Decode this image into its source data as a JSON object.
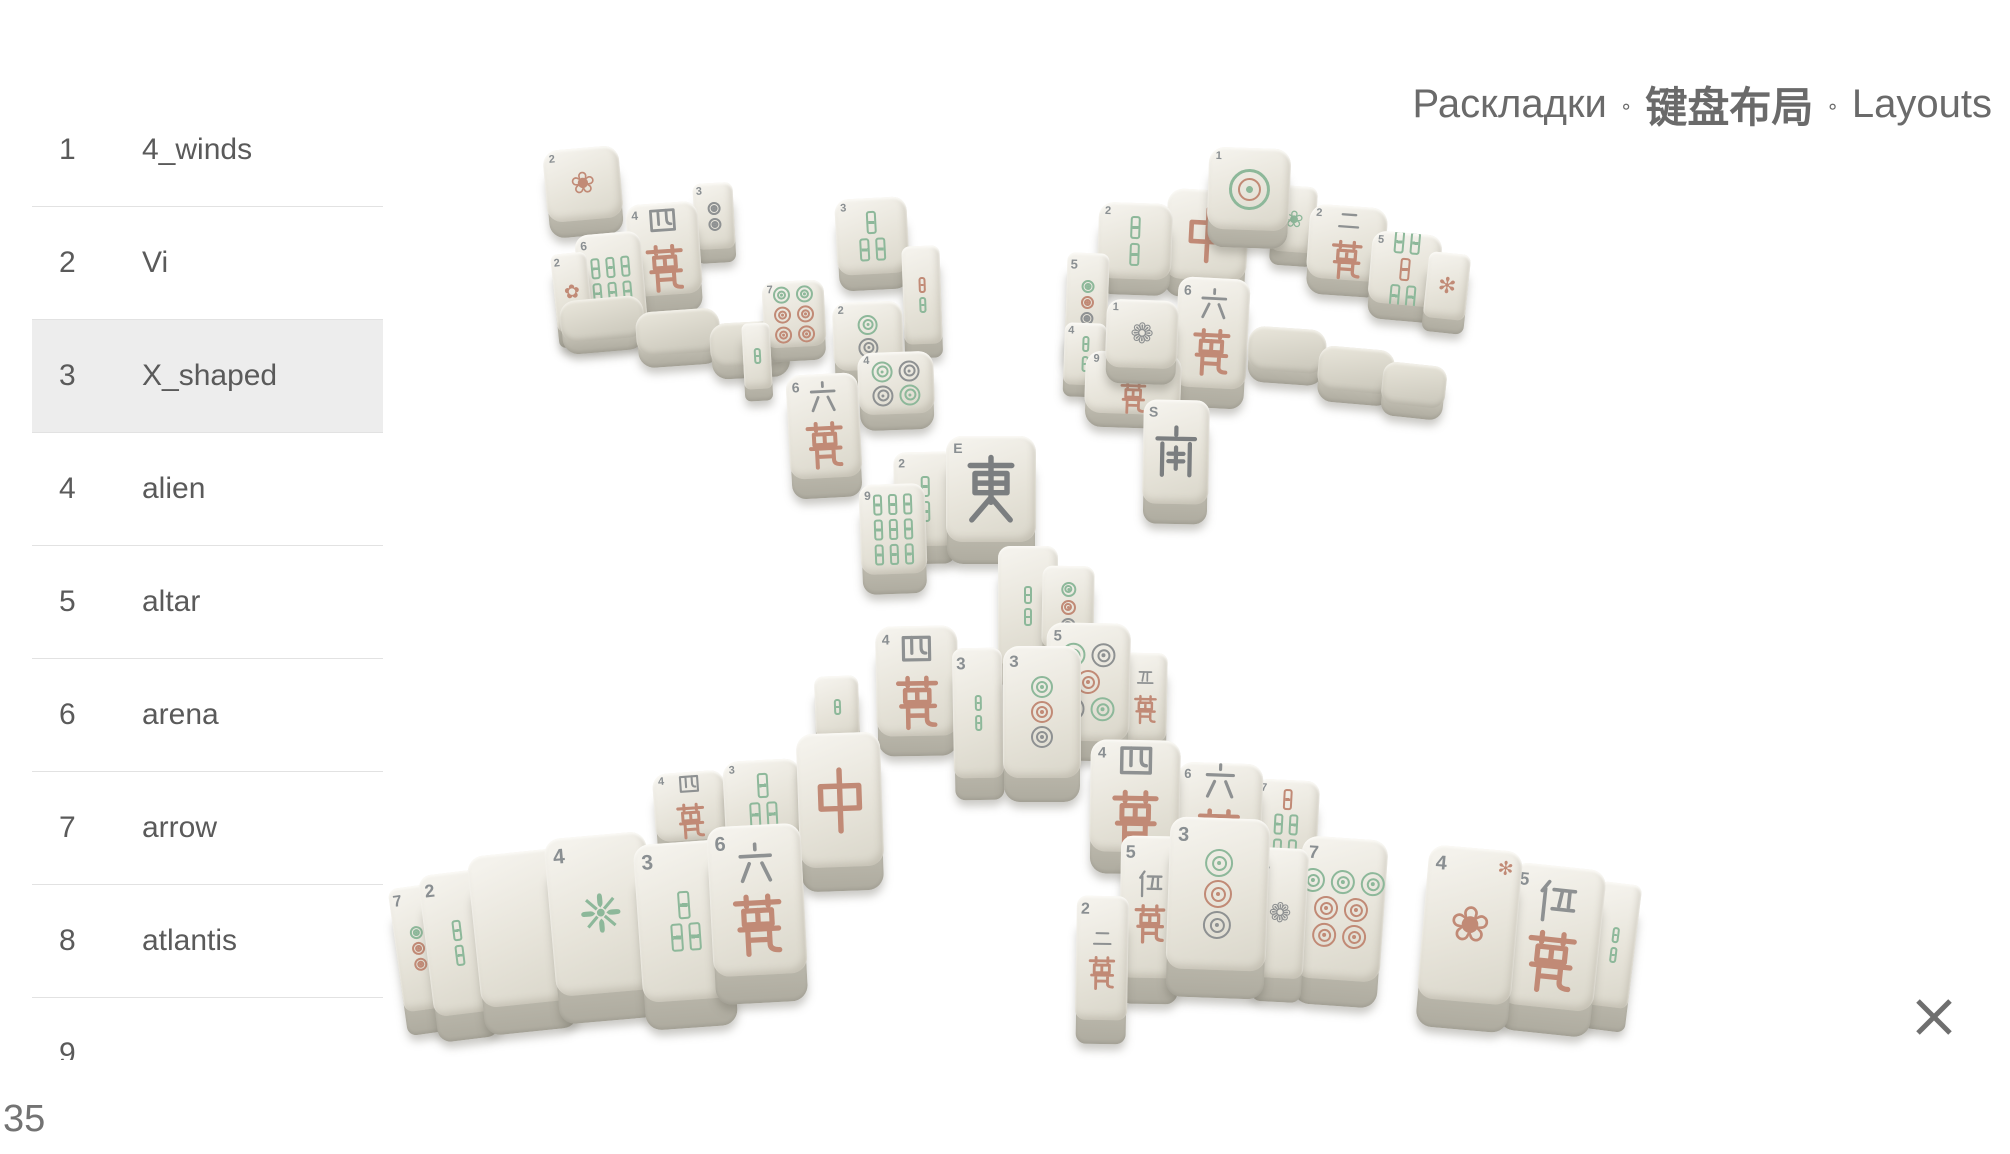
{
  "header": {
    "title_parts": [
      "Раскладки",
      "键盘布局",
      "Layouts"
    ],
    "separator": "∘"
  },
  "sidebar": {
    "selected_index": 2,
    "items": [
      {
        "num": "1",
        "name": "4_winds"
      },
      {
        "num": "2",
        "name": "Vi"
      },
      {
        "num": "3",
        "name": "X_shaped"
      },
      {
        "num": "4",
        "name": "alien"
      },
      {
        "num": "5",
        "name": "altar"
      },
      {
        "num": "6",
        "name": "arena"
      },
      {
        "num": "7",
        "name": "arrow"
      },
      {
        "num": "8",
        "name": "atlantis"
      },
      {
        "num": "9",
        "name": ""
      }
    ]
  },
  "footer": {
    "counter": "35"
  },
  "colors": {
    "selected_row_bg": "#ededed",
    "divider": "#e2e2e2",
    "list_text": "#5a5a5a",
    "title_text": "#6a6a6a",
    "close_icon": "#6f6f6f",
    "tile_salmon": "#c18a76",
    "tile_green": "#8db89a",
    "tile_gray": "#8e9192",
    "tile_dark": "#7b7e80",
    "tile_num": "#8a8f92"
  },
  "scene": {
    "layout_name": "X_shaped",
    "tiles": [
      {
        "x": 545,
        "y": 148,
        "w": 76,
        "h": 72,
        "rot": -5,
        "d": 16,
        "kind": "flora",
        "n": "2",
        "art": "❀",
        "ac": "s"
      },
      {
        "x": 694,
        "y": 183,
        "w": 40,
        "h": 66,
        "rot": -3,
        "d": 14,
        "kind": "rings",
        "n": "3",
        "rows": [
          [
            "k"
          ],
          [
            "k"
          ]
        ]
      },
      {
        "x": 628,
        "y": 203,
        "w": 72,
        "h": 92,
        "rot": -4,
        "d": 18,
        "kind": "man",
        "n": "4",
        "top": "四"
      },
      {
        "x": 578,
        "y": 233,
        "w": 66,
        "h": 94,
        "rot": -5,
        "d": 18,
        "kind": "sticks",
        "n": "6",
        "rows": [
          [
            "g",
            "g",
            "g"
          ],
          [
            "g",
            "g",
            "g"
          ]
        ]
      },
      {
        "x": 554,
        "y": 253,
        "w": 36,
        "h": 78,
        "rot": -6,
        "d": 16,
        "kind": "flora",
        "n": "2",
        "art": "✿",
        "ac": "s"
      },
      {
        "x": 560,
        "y": 298,
        "w": 84,
        "h": 42,
        "rot": -5,
        "d": 12,
        "kind": "blank",
        "base": true
      },
      {
        "x": 636,
        "y": 310,
        "w": 84,
        "h": 44,
        "rot": -4,
        "d": 12,
        "kind": "blank",
        "base": true
      },
      {
        "x": 710,
        "y": 322,
        "w": 80,
        "h": 44,
        "rot": -3,
        "d": 12,
        "kind": "blank",
        "base": true
      },
      {
        "x": 836,
        "y": 198,
        "w": 72,
        "h": 76,
        "rot": -3,
        "d": 16,
        "kind": "sticks",
        "n": "3",
        "rows": [
          [
            "g"
          ],
          [
            "g",
            "g"
          ]
        ]
      },
      {
        "x": 903,
        "y": 246,
        "w": 38,
        "h": 98,
        "rot": -2,
        "d": 14,
        "kind": "sticks",
        "rows": [
          [
            "s"
          ],
          [
            "g"
          ]
        ]
      },
      {
        "x": 763,
        "y": 281,
        "w": 62,
        "h": 66,
        "rot": -3,
        "d": 14,
        "kind": "rings",
        "n": "7",
        "rows": [
          [
            "g",
            "g"
          ],
          [
            "s",
            "s"
          ],
          [
            "s",
            "s"
          ]
        ]
      },
      {
        "x": 833,
        "y": 302,
        "w": 70,
        "h": 68,
        "rot": -2,
        "d": 16,
        "kind": "rings",
        "n": "2",
        "rows": [
          [
            "g"
          ],
          [
            "k"
          ]
        ]
      },
      {
        "x": 743,
        "y": 323,
        "w": 28,
        "h": 66,
        "rot": -3,
        "d": 12,
        "kind": "sticks",
        "rows": [
          [
            "g"
          ]
        ]
      },
      {
        "x": 858,
        "y": 352,
        "w": 76,
        "h": 62,
        "rot": -2,
        "d": 16,
        "kind": "rings",
        "n": "4",
        "rows": [
          [
            "g",
            "k"
          ],
          [
            "k",
            "g"
          ]
        ]
      },
      {
        "x": 788,
        "y": 374,
        "w": 72,
        "h": 104,
        "rot": -3,
        "d": 20,
        "kind": "man",
        "n": "6",
        "top": "六"
      },
      {
        "x": 894,
        "y": 452,
        "w": 62,
        "h": 94,
        "rot": -1,
        "d": 18,
        "kind": "sticks",
        "n": "2",
        "rows": [
          [
            "g"
          ],
          [
            "g"
          ]
        ]
      },
      {
        "x": 860,
        "y": 484,
        "w": 66,
        "h": 90,
        "rot": -2,
        "d": 20,
        "kind": "sticks",
        "n": "9",
        "rows": [
          [
            "g",
            "g",
            "g"
          ],
          [
            "g",
            "g",
            "g"
          ],
          [
            "g",
            "g",
            "g"
          ]
        ]
      },
      {
        "x": 1272,
        "y": 186,
        "w": 44,
        "h": 66,
        "rot": 4,
        "d": 14,
        "kind": "flora",
        "n": "2",
        "art": "❀",
        "ac": "g"
      },
      {
        "x": 1308,
        "y": 206,
        "w": 78,
        "h": 74,
        "rot": 4,
        "d": 16,
        "kind": "man",
        "n": "2",
        "top": "二"
      },
      {
        "x": 1370,
        "y": 233,
        "w": 70,
        "h": 72,
        "rot": 5,
        "d": 16,
        "kind": "sticks",
        "n": "5",
        "rows": [
          [
            "g",
            "g"
          ],
          [
            "s"
          ],
          [
            "g",
            "g"
          ]
        ]
      },
      {
        "x": 1426,
        "y": 253,
        "w": 42,
        "h": 66,
        "rot": 6,
        "d": 14,
        "kind": "flora",
        "art": "✻",
        "ac": "s"
      },
      {
        "x": 1166,
        "y": 190,
        "w": 82,
        "h": 90,
        "rot": 3,
        "d": 18,
        "kind": "char",
        "main": "中",
        "mainc": "s"
      },
      {
        "x": 1208,
        "y": 148,
        "w": 82,
        "h": 82,
        "rot": 2,
        "d": 18,
        "kind": "plate",
        "n": "1"
      },
      {
        "x": 1176,
        "y": 278,
        "w": 72,
        "h": 110,
        "rot": 3,
        "d": 20,
        "kind": "man",
        "n": "6",
        "top": "六"
      },
      {
        "x": 1248,
        "y": 328,
        "w": 78,
        "h": 44,
        "rot": 4,
        "d": 12,
        "kind": "blank",
        "base": true
      },
      {
        "x": 1318,
        "y": 348,
        "w": 76,
        "h": 44,
        "rot": 5,
        "d": 12,
        "kind": "blank",
        "base": true
      },
      {
        "x": 1382,
        "y": 364,
        "w": 64,
        "h": 42,
        "rot": 6,
        "d": 12,
        "kind": "blank",
        "base": true
      },
      {
        "x": 1098,
        "y": 203,
        "w": 74,
        "h": 76,
        "rot": 2,
        "d": 16,
        "kind": "sticks",
        "n": "2",
        "rows": [
          [
            "g"
          ],
          [
            "g"
          ]
        ]
      },
      {
        "x": 1066,
        "y": 253,
        "w": 42,
        "h": 98,
        "rot": 2,
        "d": 14,
        "kind": "rings",
        "n": "5",
        "rows": [
          [
            "g"
          ],
          [
            "s"
          ],
          [
            "k"
          ]
        ]
      },
      {
        "x": 1064,
        "y": 323,
        "w": 42,
        "h": 62,
        "rot": 2,
        "d": 12,
        "kind": "sticks",
        "n": "4",
        "rows": [
          [
            "g"
          ],
          [
            "g"
          ]
        ]
      },
      {
        "x": 1085,
        "y": 352,
        "w": 96,
        "h": 62,
        "rot": 2,
        "d": 14,
        "kind": "man",
        "n": "9",
        "top": "九"
      },
      {
        "x": 1106,
        "y": 300,
        "w": 72,
        "h": 68,
        "rot": 2,
        "d": 16,
        "kind": "flora",
        "n": "1",
        "art": "❁",
        "ac": "k"
      },
      {
        "x": 1143,
        "y": 400,
        "w": 66,
        "h": 104,
        "rot": 1,
        "d": 20,
        "kind": "char",
        "n": "S",
        "main": "南",
        "mainc": "d"
      },
      {
        "x": 946,
        "y": 436,
        "w": 90,
        "h": 106,
        "rot": 0,
        "d": 22,
        "kind": "char",
        "n": "E",
        "main": "東",
        "mainc": "d"
      },
      {
        "x": 998,
        "y": 546,
        "w": 60,
        "h": 120,
        "rot": 0,
        "d": 22,
        "kind": "sticks",
        "rows": [
          [
            "g"
          ],
          [
            "g"
          ]
        ]
      },
      {
        "x": 1042,
        "y": 566,
        "w": 52,
        "h": 82,
        "rot": 1,
        "d": 16,
        "kind": "rings",
        "rows": [
          [
            "g"
          ],
          [
            "s"
          ],
          [
            "k"
          ]
        ]
      },
      {
        "x": 815,
        "y": 676,
        "w": 44,
        "h": 62,
        "rot": -2,
        "d": 14,
        "kind": "sticks",
        "rows": [
          [
            "g"
          ]
        ]
      },
      {
        "x": 654,
        "y": 772,
        "w": 72,
        "h": 68,
        "rot": -4,
        "d": 16,
        "kind": "man",
        "n": "4",
        "top": "四"
      },
      {
        "x": 724,
        "y": 760,
        "w": 78,
        "h": 80,
        "rot": -3,
        "d": 18,
        "kind": "sticks",
        "n": "3",
        "rows": [
          [
            "g"
          ],
          [
            "g",
            "g"
          ]
        ]
      },
      {
        "x": 876,
        "y": 626,
        "w": 82,
        "h": 110,
        "rot": -1,
        "d": 20,
        "kind": "man",
        "n": "4",
        "top": "四"
      },
      {
        "x": 798,
        "y": 733,
        "w": 84,
        "h": 134,
        "rot": -2,
        "d": 24,
        "kind": "char",
        "main": "中",
        "mainc": "s"
      },
      {
        "x": 953,
        "y": 648,
        "w": 50,
        "h": 130,
        "rot": -1,
        "d": 22,
        "kind": "sticks",
        "n": "3",
        "rows": [
          [
            "g"
          ],
          [
            "g"
          ]
        ]
      },
      {
        "x": 1123,
        "y": 653,
        "w": 44,
        "h": 88,
        "rot": 1,
        "d": 16,
        "kind": "man",
        "top": "五"
      },
      {
        "x": 1046,
        "y": 623,
        "w": 84,
        "h": 118,
        "rot": 1,
        "d": 20,
        "kind": "rings",
        "n": "5",
        "rows": [
          [
            "g",
            "k"
          ],
          [
            "s"
          ],
          [
            "k",
            "g"
          ]
        ]
      },
      {
        "x": 1003,
        "y": 646,
        "w": 78,
        "h": 132,
        "rot": 0,
        "d": 24,
        "kind": "rings",
        "n": "3",
        "rows": [
          [
            "g"
          ],
          [
            "s"
          ],
          [
            "k"
          ]
        ]
      },
      {
        "x": 1254,
        "y": 780,
        "w": 64,
        "h": 88,
        "rot": 3,
        "d": 18,
        "kind": "sticks",
        "n": "7",
        "rows": [
          [
            "s"
          ],
          [
            "g",
            "g"
          ],
          [
            "g",
            "g"
          ]
        ]
      },
      {
        "x": 1176,
        "y": 763,
        "w": 86,
        "h": 102,
        "rot": 2,
        "d": 20,
        "kind": "man",
        "n": "6",
        "top": "六"
      },
      {
        "x": 1090,
        "y": 740,
        "w": 90,
        "h": 112,
        "rot": 1,
        "d": 22,
        "kind": "man",
        "n": "4",
        "top": "四"
      },
      {
        "x": 396,
        "y": 886,
        "w": 44,
        "h": 124,
        "rot": -8,
        "d": 24,
        "kind": "rings",
        "n": "7",
        "rows": [
          [
            "g"
          ],
          [
            "s"
          ],
          [
            "s"
          ]
        ]
      },
      {
        "x": 426,
        "y": 872,
        "w": 64,
        "h": 142,
        "rot": -7,
        "d": 26,
        "kind": "sticks",
        "n": "2",
        "rows": [
          [
            "g"
          ],
          [
            "g"
          ]
        ]
      },
      {
        "x": 474,
        "y": 852,
        "w": 96,
        "h": 152,
        "rot": -6,
        "d": 28,
        "kind": "blank"
      },
      {
        "x": 550,
        "y": 835,
        "w": 102,
        "h": 158,
        "rot": -5,
        "d": 28,
        "kind": "flora",
        "n": "4",
        "art": "❈",
        "ac": "g"
      },
      {
        "x": 638,
        "y": 842,
        "w": 94,
        "h": 158,
        "rot": -4,
        "d": 28,
        "kind": "sticks",
        "n": "3",
        "rows": [
          [
            "g"
          ],
          [
            "g",
            "g"
          ]
        ]
      },
      {
        "x": 710,
        "y": 825,
        "w": 94,
        "h": 150,
        "rot": -3,
        "d": 28,
        "kind": "man",
        "n": "6",
        "top": "六"
      },
      {
        "x": 1593,
        "y": 883,
        "w": 42,
        "h": 124,
        "rot": 7,
        "d": 24,
        "kind": "sticks",
        "rows": [
          [
            "g"
          ],
          [
            "g"
          ]
        ]
      },
      {
        "x": 1506,
        "y": 866,
        "w": 94,
        "h": 142,
        "rot": 6,
        "d": 26,
        "kind": "man",
        "n": "5",
        "top": "伍"
      },
      {
        "x": 1423,
        "y": 848,
        "w": 94,
        "h": 154,
        "rot": 5,
        "d": 28,
        "kind": "flora",
        "n": "4",
        "art": "❀",
        "ac": "s",
        "extra": "✻"
      },
      {
        "x": 1298,
        "y": 838,
        "w": 86,
        "h": 142,
        "rot": 4,
        "d": 26,
        "kind": "rings",
        "n": "7",
        "rows": [
          [
            "g",
            "g",
            "g"
          ],
          [
            "s",
            "s"
          ],
          [
            "s",
            "s"
          ]
        ]
      },
      {
        "x": 1254,
        "y": 848,
        "w": 52,
        "h": 130,
        "rot": 3,
        "d": 24,
        "kind": "flora",
        "n": "1",
        "art": "❁",
        "ac": "k"
      },
      {
        "x": 1120,
        "y": 836,
        "w": 60,
        "h": 142,
        "rot": 1,
        "d": 26,
        "kind": "man",
        "n": "5",
        "top": "伍"
      },
      {
        "x": 1076,
        "y": 896,
        "w": 52,
        "h": 124,
        "rot": 1,
        "d": 24,
        "kind": "man",
        "n": "2",
        "top": "二"
      },
      {
        "x": 1168,
        "y": 818,
        "w": 100,
        "h": 152,
        "rot": 2,
        "d": 28,
        "kind": "rings",
        "n": "3",
        "rows": [
          [
            "g"
          ],
          [
            "s"
          ],
          [
            "k"
          ]
        ]
      }
    ]
  }
}
